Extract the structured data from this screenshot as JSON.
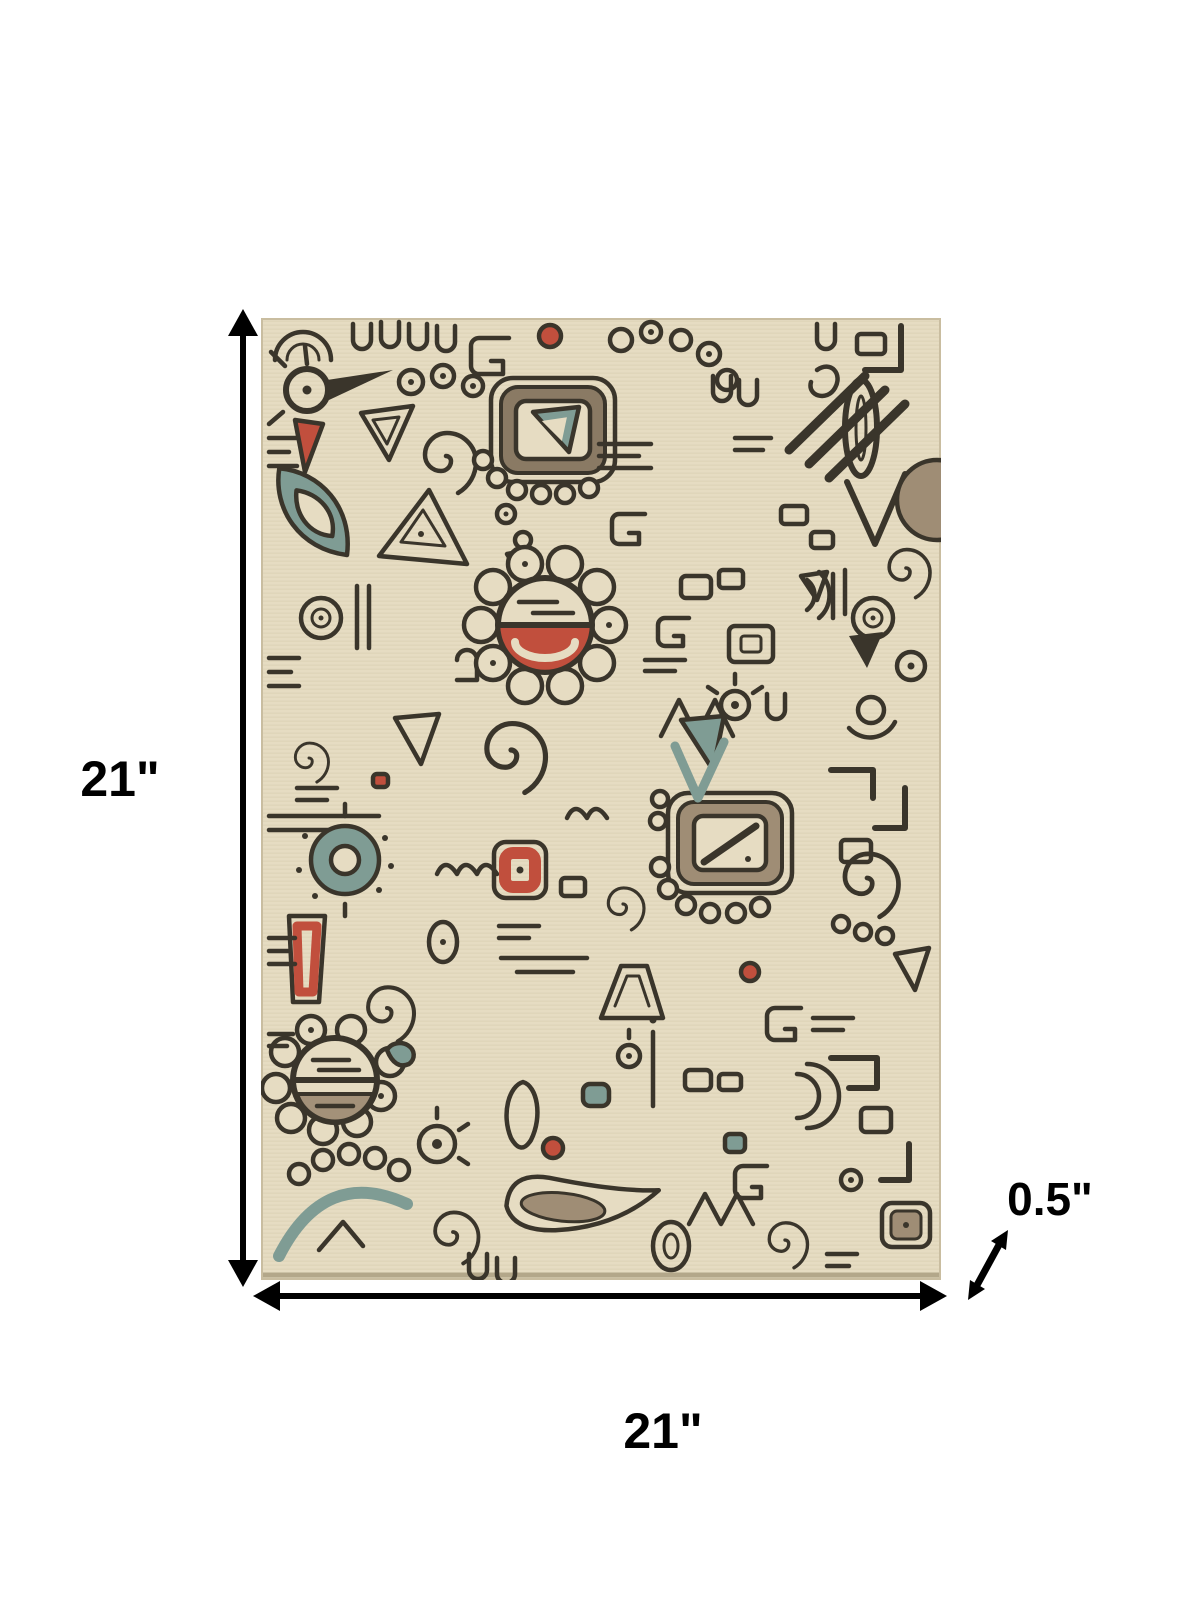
{
  "diagram": {
    "type": "product-dimension-diagram",
    "product": "doodle-pattern-area-rug",
    "dimensions": {
      "height_label": "21\"",
      "width_label": "21\"",
      "thickness_label": "0.5\""
    },
    "colors": {
      "page_background": "#ffffff",
      "arrow": "#000000",
      "rug_background": "#e6dcc2",
      "rug_line": "#3a352b",
      "rug_teal": "#7f9c94",
      "rug_red": "#c14f3d",
      "rug_tan": "#9f8d75"
    }
  }
}
